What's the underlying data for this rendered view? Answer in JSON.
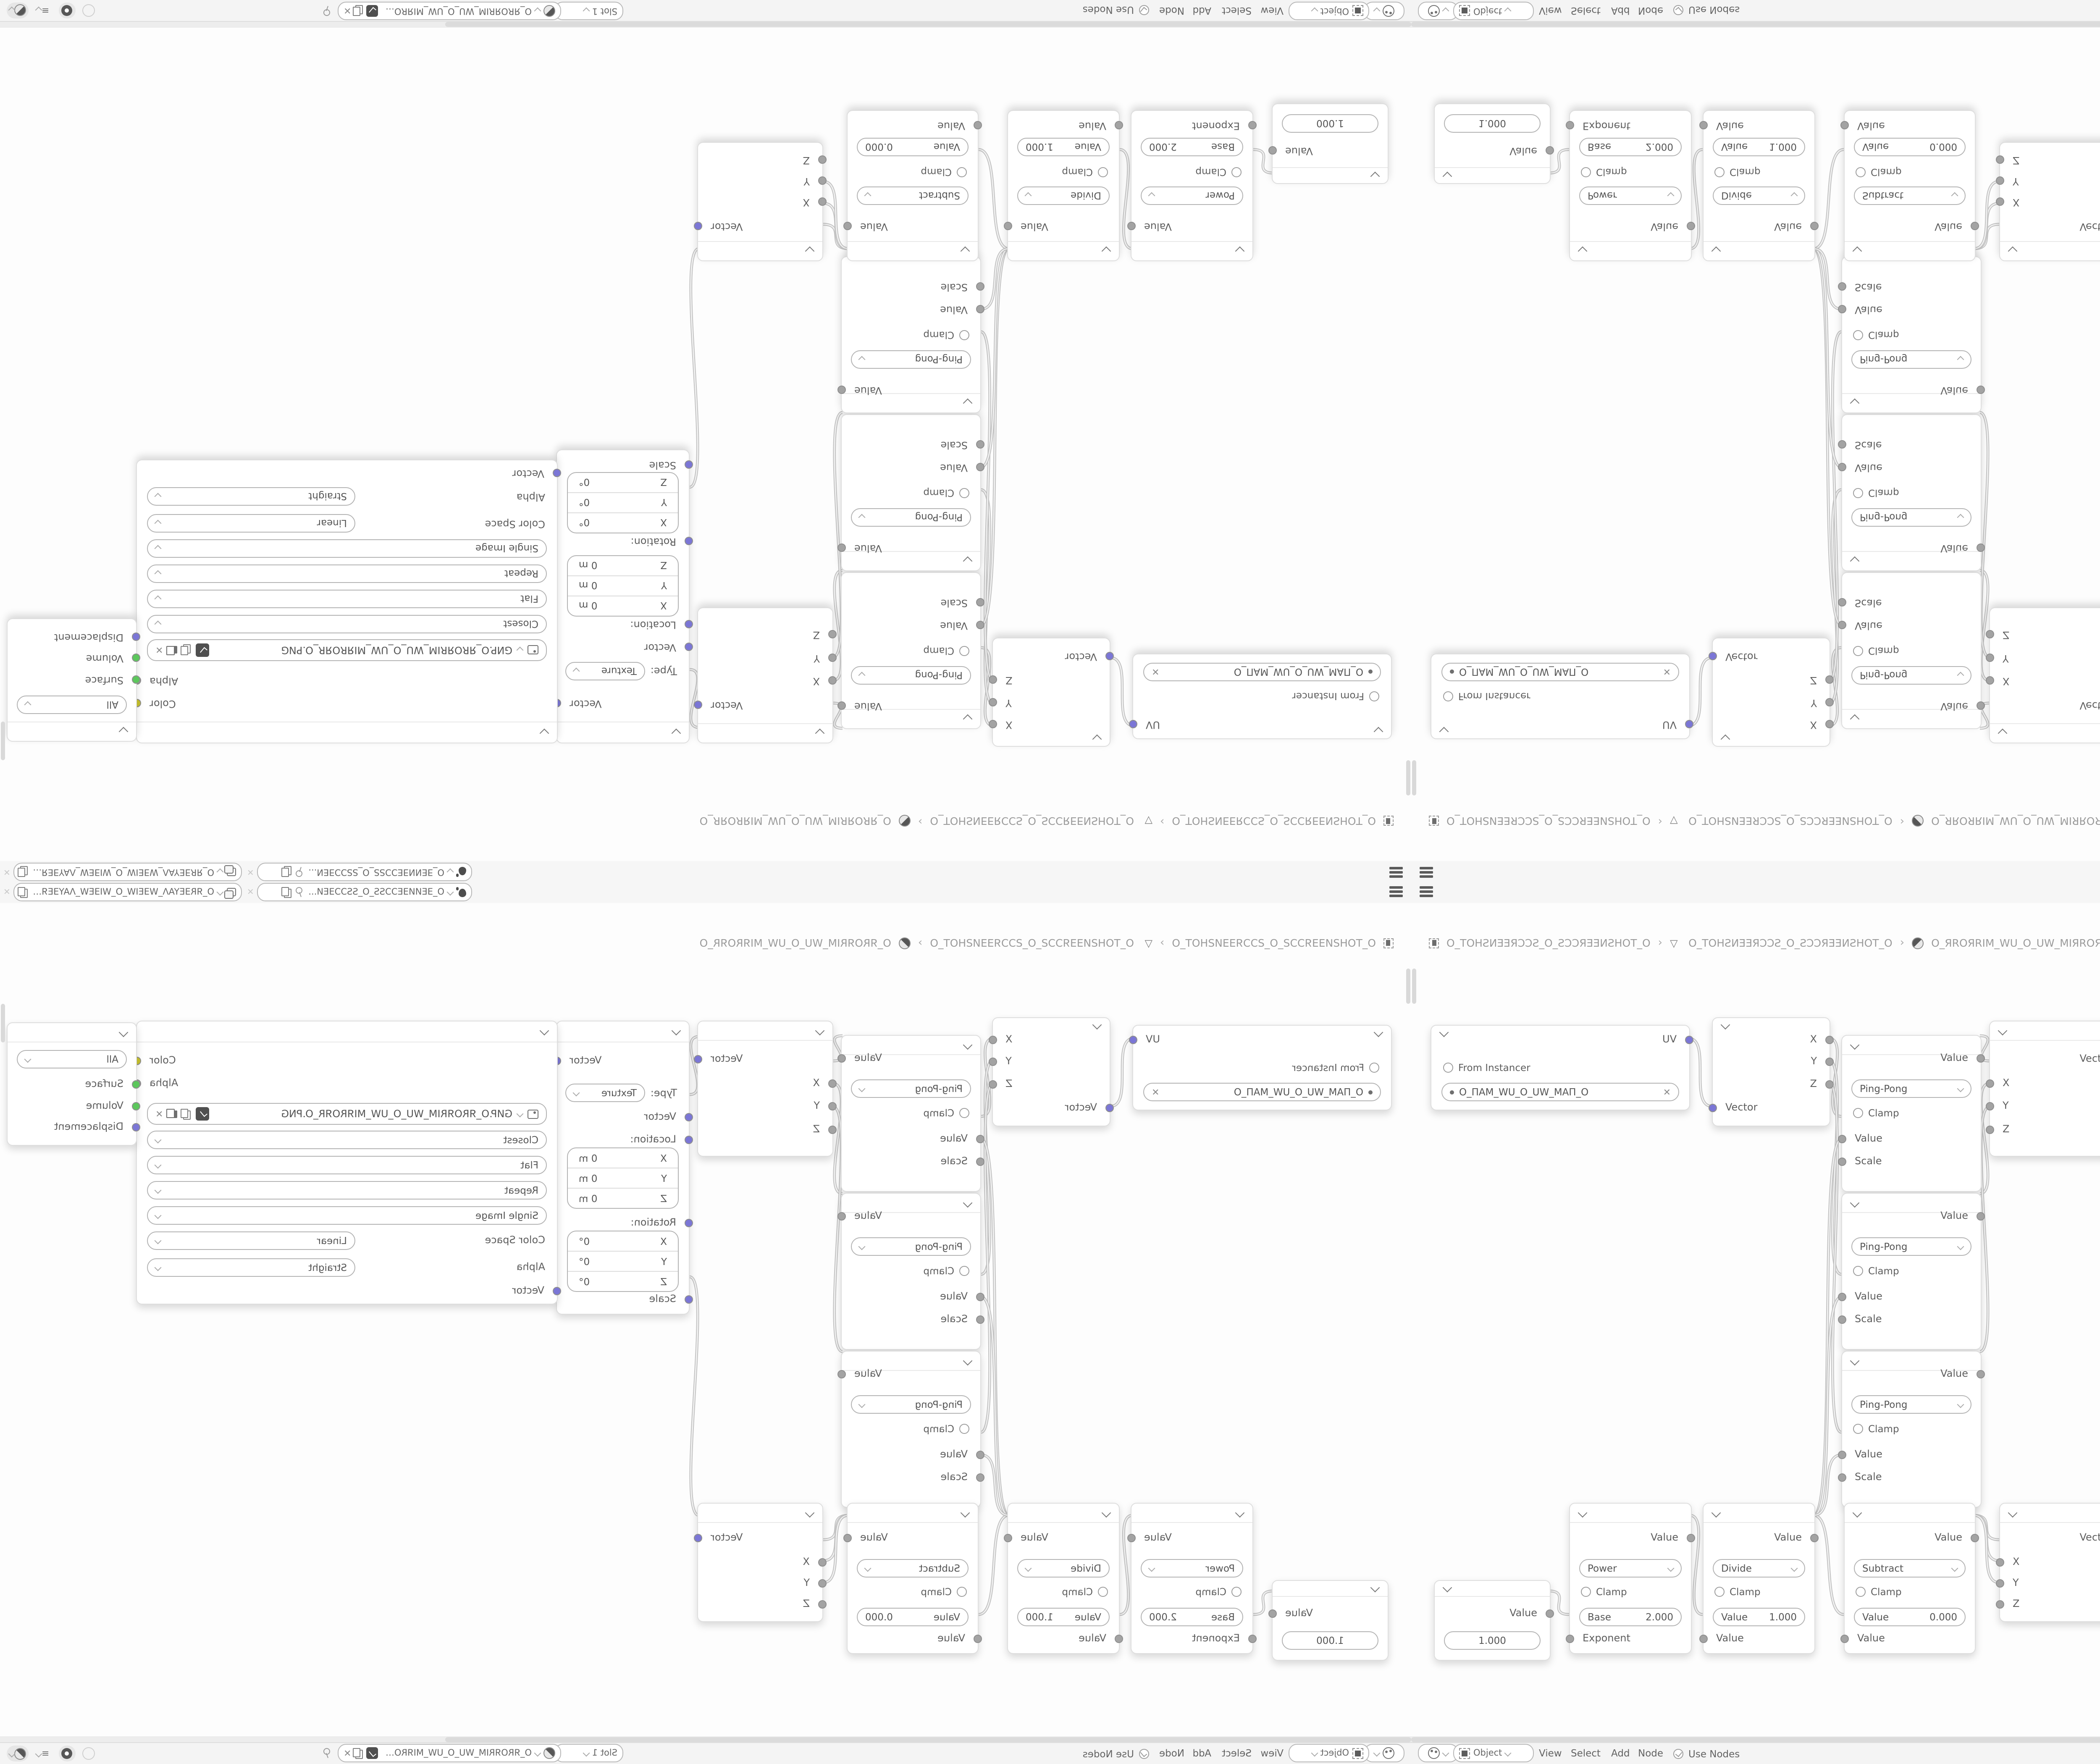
{
  "window": {
    "topbar": {
      "scene": {
        "icon": "scene-icon",
        "value": "O_ƎEИИƎEƆƆSS_O_SSƆƆƎEИ..."
      },
      "view_layer": {
        "icon": "view-layer-icon",
        "value": "O_ЯRƎEYAΛ_WƎEIW_O_WIƎEW_ΛAYƎEЯR_O"
      }
    },
    "breadcrumb": {
      "separator": "›",
      "items": [
        {
          "icon": "screen-icon",
          "label": "O_TOHƧИƎƎЯƆƆƧ_O_ƧƆƆЯƎƎИƧHOT_O"
        },
        {
          "icon": "object-data-icon",
          "label": "O_TOHƧИƎƎЯƆƆƧ_O_ƧƆƆЯƎƎИƧHOT_O",
          "tri": "▽"
        },
        {
          "icon": "material-icon",
          "label": "O_ЯROЯRIM_WU_O_UW_MIЯROЯR_O"
        }
      ]
    },
    "nodes": {
      "uvmap": {
        "output": "UV",
        "checkbox": "From Instancer",
        "uv_name": "O_ПAM_WU_O_UW_MAП_O"
      },
      "separate": {
        "out_x": "X",
        "out_y": "Y",
        "out_z": "Z",
        "input": "Vector"
      },
      "math": {
        "output": "Value",
        "operation": "Ping-Pong",
        "clamp": "Clamp",
        "in_value": "Value",
        "in_scale": "Scale"
      },
      "combine": {
        "output": "Vector",
        "in_x": "X",
        "in_y": "Y",
        "in_z": "Z"
      },
      "mapping": {
        "output": "Vector",
        "type_label": "Type:",
        "type": "Texture",
        "input": "Vector",
        "location_label": "Location:",
        "rotation_label": "Rotation:",
        "scale_label": "Scale",
        "loc_x_label": "X",
        "loc_x": "0 m",
        "loc_y_label": "Y",
        "loc_y": "0 m",
        "loc_z_label": "Z",
        "loc_z": "0 m",
        "rot_x_label": "X",
        "rot_x": "0°",
        "rot_y_label": "Y",
        "rot_y": "0°",
        "rot_z_label": "Z",
        "rot_z": "0°"
      },
      "texture": {
        "out_color": "Color",
        "out_alpha": "Alpha",
        "filename": "GИP.O_ЯROЯRIM_WU_O_UW_MIЯROЯR_O.PNG",
        "interpolation": "Closest",
        "projection": "Flat",
        "extension": "Repeat",
        "source": "Single Image",
        "color_space_label": "Color Space",
        "color_space": "Linear",
        "alpha_label": "Alpha",
        "alpha_mode": "Straight",
        "input": "Vector"
      },
      "output": {
        "target": "All",
        "in_surface": "Surface",
        "in_volume": "Volume",
        "in_displacement": "Displacement"
      },
      "value": {
        "output": "Value",
        "value": "1.000"
      },
      "power": {
        "output": "Value",
        "operation": "Power",
        "clamp": "Clamp",
        "field_label": "Base",
        "field_value": "2.000",
        "input": "Exponent"
      },
      "divide": {
        "output": "Value",
        "operation": "Divide",
        "clamp": "Clamp",
        "field_label": "Value",
        "field_value": "1.000",
        "input": "Value"
      },
      "subtract": {
        "output": "Value",
        "operation": "Subtract",
        "clamp": "Clamp",
        "field_label": "Value",
        "field_value": "0.000",
        "input": "Value"
      }
    },
    "header": {
      "shader_type": "Object",
      "menus": [
        "View",
        "Select",
        "Add",
        "Node"
      ],
      "use_nodes": "Use Nodes",
      "slot": "Slot 1",
      "material": "O_ЯROЯRIM_WU_O_UW_MIЯROЯR_O"
    },
    "links": [
      [
        330,
        186,
        358,
        267
      ],
      [
        497,
        186,
        512,
        279
      ],
      [
        497,
        212,
        512,
        467
      ],
      [
        497,
        239,
        512,
        655
      ],
      [
        677,
        183,
        688,
        213
      ],
      [
        677,
        371,
        688,
        240
      ],
      [
        677,
        559,
        688,
        268
      ],
      [
        848,
        184,
        859,
        253
      ],
      [
        1016,
        186,
        1016,
        460
      ],
      [
        1516,
        186,
        1517,
        214
      ],
      [
        164,
        844,
        188,
        872
      ],
      [
        332,
        754,
        347,
        872
      ],
      [
        479,
        754,
        515,
        872
      ],
      [
        479,
        754,
        512,
        306
      ],
      [
        479,
        754,
        512,
        494
      ],
      [
        479,
        754,
        512,
        682
      ],
      [
        670,
        754,
        700,
        783
      ],
      [
        670,
        754,
        700,
        808
      ],
      [
        670,
        754,
        700,
        834
      ],
      [
        848,
        754,
        859,
        470
      ]
    ],
    "colors": {
      "socket_vector": "#7b76d6",
      "socket_value": "#a3a3a3",
      "socket_color": "#c9c32c",
      "socket_shader": "#5cc75c",
      "link": "#c2c2c2",
      "canvas": "#fdfdfd",
      "bar": "#f4f4f4"
    }
  }
}
